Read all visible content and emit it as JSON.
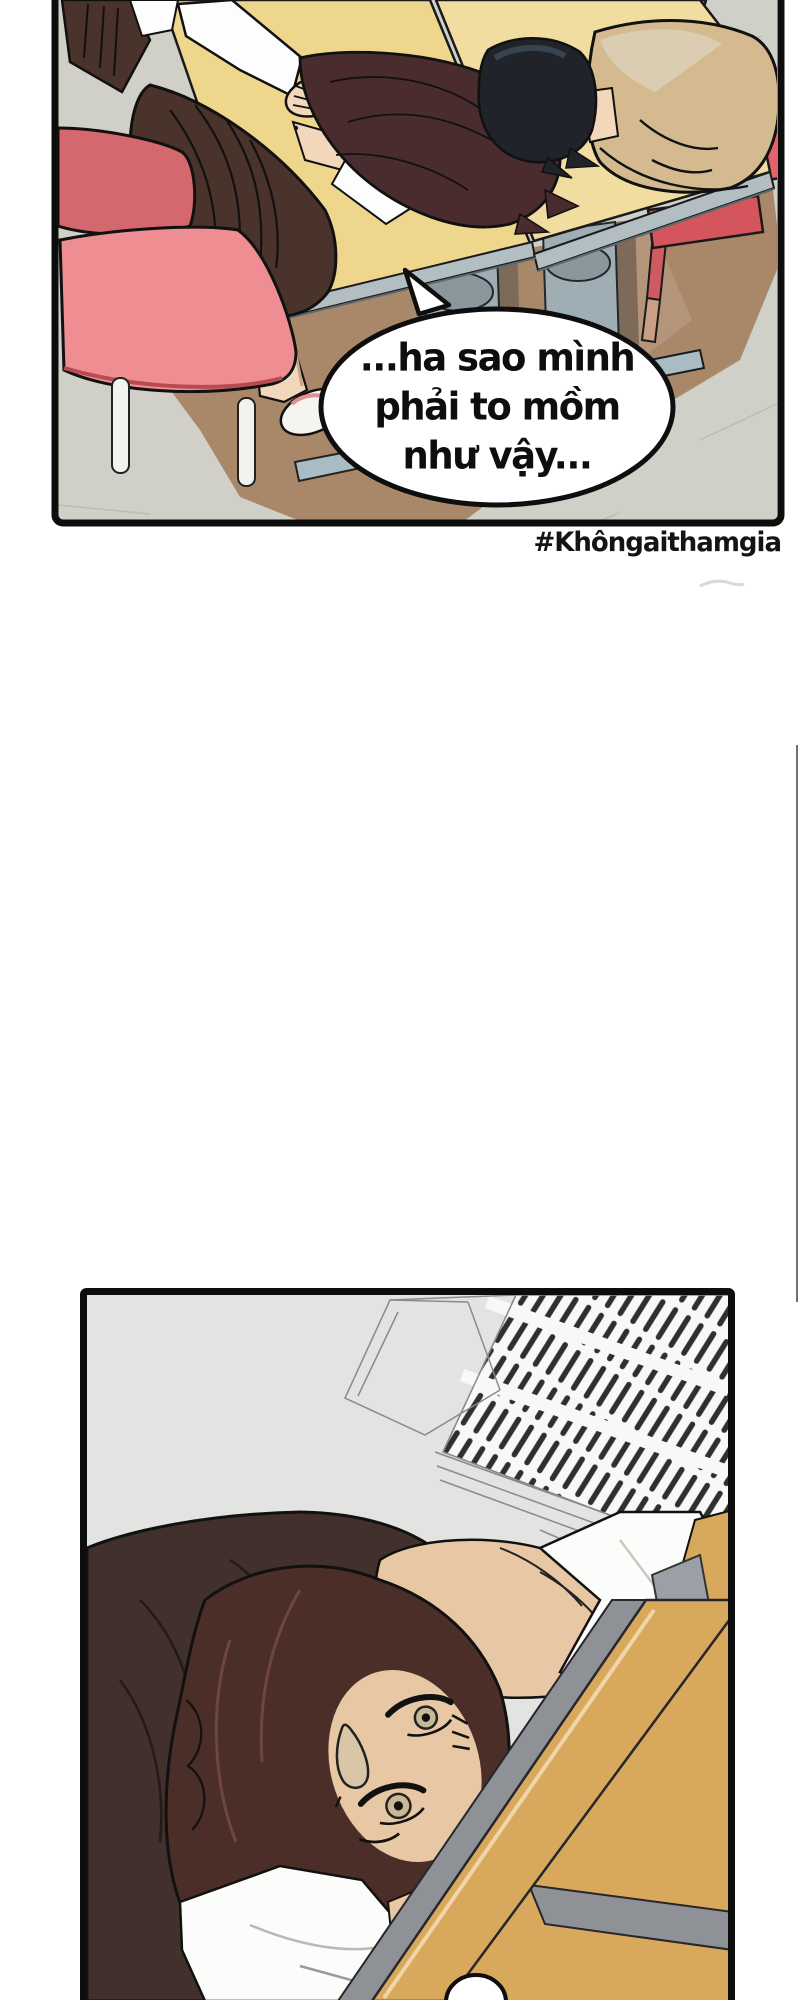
{
  "comic": {
    "panel1": {
      "speech_bubble": {
        "line1": "...ha sao mình",
        "line2": "phải to mồm",
        "line3": "như vậy..."
      },
      "hashtag": "#Khôngaithamgia"
    },
    "panel2": {}
  },
  "colors": {
    "page_bg": "#ffffff",
    "panel_border": "#0d0d0d",
    "floor_gray": "#d0d0c8",
    "floor_brown": "#a9886a",
    "table_tan": "#eed68d",
    "table_tan_light": "#f1dd9f",
    "table_trim": "#b3bec3",
    "chair_pink_seat": "#ee8e92",
    "chair_pink_back": "#d5686e",
    "chair_red": "#e4636a",
    "dress_brown": "#4a332a",
    "hair_maroon": "#4b2c2e",
    "hair_black": "#20242a",
    "jacket_beige": "#d4ba8e",
    "skin": "#f3d7ba",
    "ceiling_gray": "#e3e3e1",
    "vent_slat": "#2f2f2f",
    "hair_dark_brown": "#4c2e29",
    "clothing_dark": "#41302b",
    "skin_warm": "#e8c8a4",
    "wood_tan": "#d8a85c",
    "metal_gray": "#8e9297",
    "bubble_fill": "#ffffff",
    "text_color": "#111111"
  }
}
